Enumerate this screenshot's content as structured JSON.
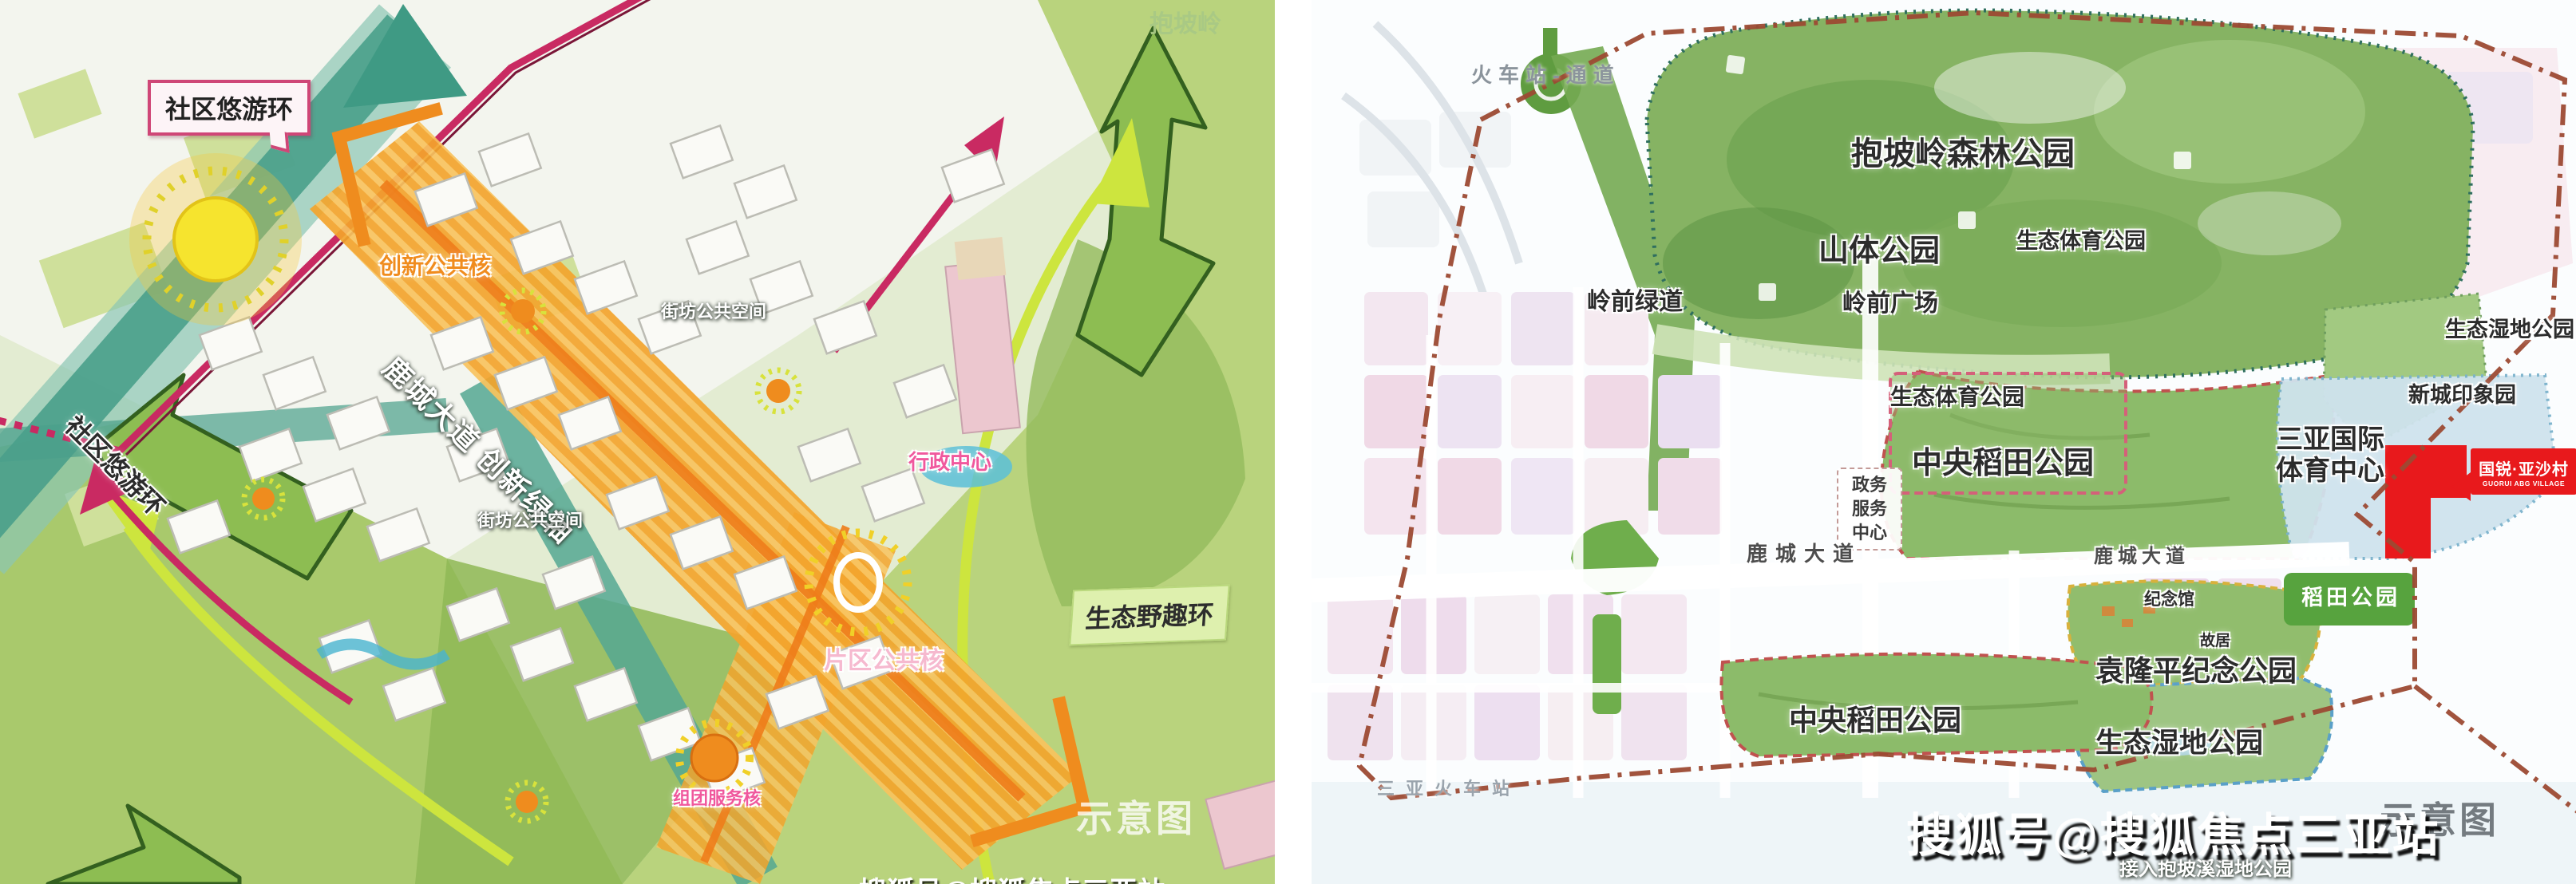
{
  "left_panel": {
    "community_ring_top": "社区悠游环",
    "community_ring_left": "社区悠游环",
    "innovation_core": "创新公共核",
    "block_space_upper": "街坊公共空间",
    "block_space_lower": "街坊公共空间",
    "axis": "鹿城大道 创新绿轴",
    "admin_center": "行政中心",
    "district_core": "片区公共核",
    "cluster_core": "组团服务核",
    "eco_ring": "生态野趣环",
    "baopoling": "抱坡岭",
    "schematic": "示意图"
  },
  "right_panel": {
    "station_corridor": "火车站-通道",
    "forest_park": "抱坡岭森林公园",
    "mountain_park": "山体公园",
    "eco_sports_park_top": "生态体育公园",
    "lingqian_plaza": "岭前广场",
    "lingqian_greenway": "岭前绿道",
    "wetland_park_right": "生态湿地公园",
    "new_town_garden": "新城印象园",
    "intl_sports_center_line1": "三亚国际",
    "intl_sports_center_line2": "体育中心",
    "eco_sports_park_mid": "生态体育公园",
    "central_rice_park_upper": "中央稻田公园",
    "gov_center_line1": "政务",
    "gov_center_line2": "服务",
    "gov_center_line3": "中心",
    "lucheng_avenue_left": "鹿城大道",
    "lucheng_avenue_right": "鹿城大道",
    "memorial_hall": "纪念馆",
    "former_residence": "故居",
    "yuan_longping_park": "袁隆平纪念公园",
    "central_rice_park_lower": "中央稻田公园",
    "wetland_park_lower": "生态湿地公园",
    "rice_park_badge": "稻田公园",
    "sanya_station": "三亚火车站",
    "connect_wetland": "接入抱坡溪湿地公园",
    "schematic": "示意图",
    "logo": {
      "cn": "国锐·亚沙村",
      "en": "GUORUI ABG VILLAGE"
    }
  },
  "watermarks": {
    "sohu": "搜狐号@搜狐焦点三亚站",
    "sohu_partial": "搜狐号@搜狐焦点三亚站"
  },
  "colors": {
    "ring_pink": "#c92a62",
    "eco_ring_yellow_green": "#cde53e",
    "corridor_teal": "#4aa08b",
    "axis_orange": "#f3a42c",
    "core_yellow": "#f6e42e",
    "boundary_red_brown": "#9c4a33",
    "park_green": "#86b363",
    "logo_red": "#e8191c",
    "pastel_pink_block": "#f0d9e6",
    "sports_center_blue": "#cfe3ee"
  }
}
